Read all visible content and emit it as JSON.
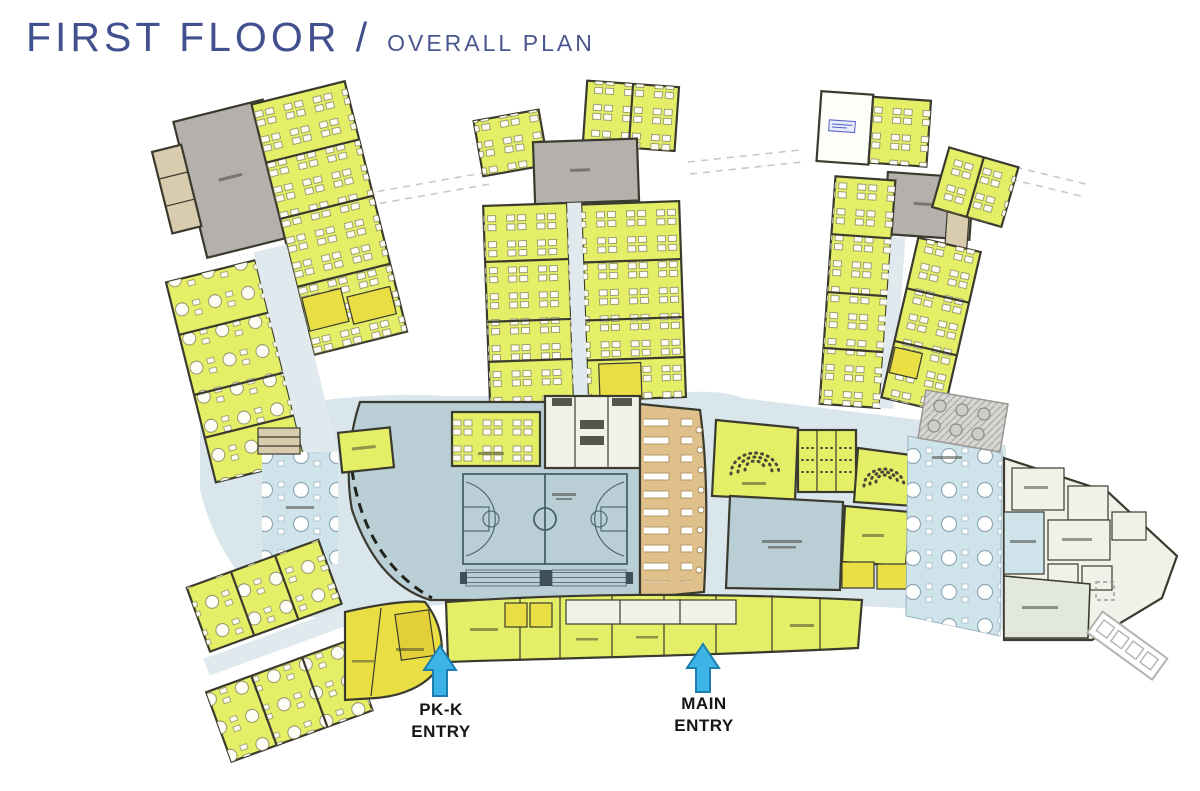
{
  "title": {
    "main": "FIRST FLOOR /",
    "sub": "OVERALL PLAN"
  },
  "entries": {
    "pk": {
      "line1": "PK-K",
      "line2": "ENTRY"
    },
    "main": {
      "line1": "MAIN",
      "line2": "ENTRY"
    }
  },
  "palette": {
    "title_text": "#42508d",
    "classroom": "#e4ee67",
    "classroom_bright": "#e9df45",
    "wall": "#3a3a2e",
    "corridor": "#dfe9ee",
    "courtyard": "#b4b1ac",
    "commons": "#d9e6ec",
    "gym_floor": "#b9ced5",
    "court_line": "#44616c",
    "cafeteria": "#dfc08a",
    "stair": "#d9cbae",
    "dining": "#cfe3eb",
    "kitchen": "#f0f2ea",
    "entry_arrow": "#3cb4e7",
    "entry_text": "#151515"
  }
}
